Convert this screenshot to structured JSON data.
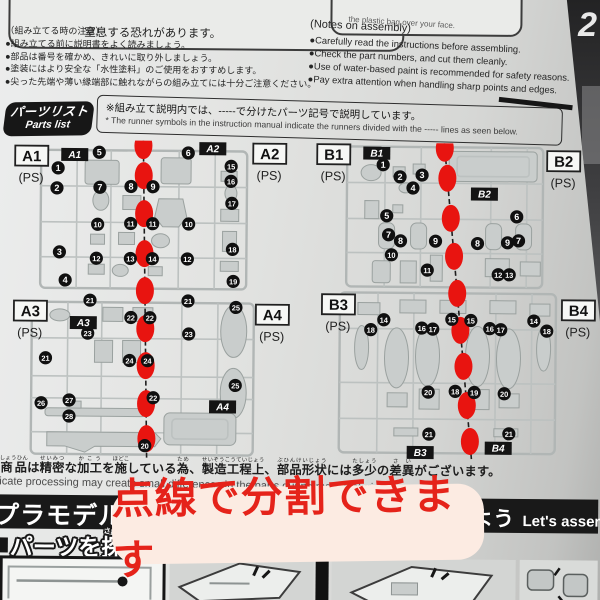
{
  "colors": {
    "marker_red": "#e81410",
    "banner_text": "#e5231a",
    "banner_bg": "#fcebe2"
  },
  "warnings": {
    "left_text": "窒息する恐れがあります。",
    "right_text": "the plastic bag over your face."
  },
  "notes_jp": {
    "title": "（組み立てる時の注意）",
    "items": [
      "●組み立てる前に説明書をよく読みましょう。",
      "●部品は番号を確かめ、きれいに取り外しましょう。",
      "●塗装にはより安全な「水性塗料」のご使用をおすすめします。",
      "●尖った先端や薄い縁端部に触れながらの組み立てには十分ご注意ください。"
    ]
  },
  "notes_en": {
    "title": "(Notes on assembly)",
    "items": [
      "●Carefully read the instructions before assembling.",
      "●Check the part numbers, and cut them cleanly.",
      "●Use of water-based paint is recommended for safety reasons.",
      "●Pay extra attention when handling sharp points and edges."
    ]
  },
  "parts_list": {
    "badge_line1": "パーツリスト",
    "badge_line2": "Parts list",
    "note_jp": "※組み立て説明内では、-----で分けたパーツ記号で説明しています。",
    "note_en": "* The runner symbols in the instruction manual indicate the runners divided with the ----- lines as seen below."
  },
  "runners": {
    "material": "(PS)",
    "blocks": [
      {
        "id": "A",
        "line": {
          "x1": 142,
          "y1": 0,
          "x2": 148,
          "y2": 318
        },
        "dots": [
          5,
          35,
          73,
          113,
          150,
          188,
          225,
          263,
          298
        ],
        "labels": [
          {
            "t": "A1",
            "x": 14,
            "y": 6
          },
          {
            "t": "A2",
            "x": 252,
            "y": 2
          },
          {
            "t": "A3",
            "x": 14,
            "y": 161
          },
          {
            "t": "A4",
            "x": 256,
            "y": 163
          }
        ],
        "badges": [
          {
            "t": "A1",
            "x": 60,
            "y": 8
          },
          {
            "t": "A2",
            "x": 198,
            "y": 1
          },
          {
            "t": "A3",
            "x": 70,
            "y": 176
          },
          {
            "t": "A4",
            "x": 210,
            "y": 259
          }
        ],
        "circles": [
          {
            "n": "1",
            "x": 57,
            "y": 28
          },
          {
            "n": "2",
            "x": 56,
            "y": 48
          },
          {
            "n": "3",
            "x": 59,
            "y": 112
          },
          {
            "n": "4",
            "x": 65,
            "y": 140
          },
          {
            "n": "5",
            "x": 98,
            "y": 12
          },
          {
            "n": "7",
            "x": 99,
            "y": 47
          },
          {
            "n": "8",
            "x": 130,
            "y": 46
          },
          {
            "n": "9",
            "x": 152,
            "y": 46
          },
          {
            "n": "10",
            "x": 97,
            "y": 84
          },
          {
            "n": "11",
            "x": 130,
            "y": 83
          },
          {
            "n": "11",
            "x": 152,
            "y": 83
          },
          {
            "n": "12",
            "x": 96,
            "y": 118
          },
          {
            "n": "13",
            "x": 130,
            "y": 118
          },
          {
            "n": "14",
            "x": 152,
            "y": 118
          },
          {
            "n": "6",
            "x": 187,
            "y": 12
          },
          {
            "n": "10",
            "x": 188,
            "y": 83
          },
          {
            "n": "12",
            "x": 187,
            "y": 118
          },
          {
            "n": "15",
            "x": 230,
            "y": 25
          },
          {
            "n": "16",
            "x": 230,
            "y": 40
          },
          {
            "n": "17",
            "x": 231,
            "y": 62
          },
          {
            "n": "18",
            "x": 232,
            "y": 108
          },
          {
            "n": "19",
            "x": 233,
            "y": 140
          },
          {
            "n": "21",
            "x": 90,
            "y": 160
          },
          {
            "n": "22",
            "x": 131,
            "y": 177
          },
          {
            "n": "22",
            "x": 150,
            "y": 177
          },
          {
            "n": "23",
            "x": 88,
            "y": 193
          },
          {
            "n": "21",
            "x": 46,
            "y": 218
          },
          {
            "n": "24",
            "x": 130,
            "y": 220
          },
          {
            "n": "24",
            "x": 148,
            "y": 220
          },
          {
            "n": "26",
            "x": 42,
            "y": 263
          },
          {
            "n": "27",
            "x": 70,
            "y": 260
          },
          {
            "n": "28",
            "x": 70,
            "y": 276
          },
          {
            "n": "21",
            "x": 188,
            "y": 160
          },
          {
            "n": "23",
            "x": 189,
            "y": 193
          },
          {
            "n": "25",
            "x": 236,
            "y": 166
          },
          {
            "n": "25",
            "x": 236,
            "y": 244
          },
          {
            "n": "22",
            "x": 154,
            "y": 257
          },
          {
            "n": "20",
            "x": 146,
            "y": 305
          }
        ]
      },
      {
        "id": "B",
        "line": {
          "x1": 143,
          "y1": 0,
          "x2": 173,
          "y2": 318
        },
        "dots": [
          5,
          35,
          75,
          113,
          150,
          187,
          223,
          262,
          298
        ],
        "labels": [
          {
            "t": "B1",
            "x": 16,
            "y": 2
          },
          {
            "t": "B2",
            "x": 246,
            "y": 7
          },
          {
            "t": "B3",
            "x": 22,
            "y": 152
          },
          {
            "t": "B4",
            "x": 262,
            "y": 156
          }
        ],
        "badges": [
          {
            "t": "B1",
            "x": 62,
            "y": 4
          },
          {
            "t": "B2",
            "x": 170,
            "y": 44
          },
          {
            "t": "B3",
            "x": 108,
            "y": 303
          },
          {
            "t": "B4",
            "x": 186,
            "y": 298
          }
        ],
        "circles": [
          {
            "n": "1",
            "x": 82,
            "y": 22
          },
          {
            "n": "2",
            "x": 99,
            "y": 34
          },
          {
            "n": "3",
            "x": 121,
            "y": 32
          },
          {
            "n": "4",
            "x": 112,
            "y": 45
          },
          {
            "n": "5",
            "x": 86,
            "y": 73
          },
          {
            "n": "6",
            "x": 216,
            "y": 73
          },
          {
            "n": "7",
            "x": 88,
            "y": 92
          },
          {
            "n": "8",
            "x": 100,
            "y": 98
          },
          {
            "n": "9",
            "x": 135,
            "y": 98
          },
          {
            "n": "8",
            "x": 177,
            "y": 100
          },
          {
            "n": "9",
            "x": 207,
            "y": 99
          },
          {
            "n": "7",
            "x": 218,
            "y": 97
          },
          {
            "n": "10",
            "x": 91,
            "y": 112
          },
          {
            "n": "11",
            "x": 127,
            "y": 127
          },
          {
            "n": "12",
            "x": 198,
            "y": 131
          },
          {
            "n": "13",
            "x": 209,
            "y": 131
          },
          {
            "n": "14",
            "x": 84,
            "y": 177
          },
          {
            "n": "15",
            "x": 152,
            "y": 176
          },
          {
            "n": "15",
            "x": 171,
            "y": 177
          },
          {
            "n": "14",
            "x": 234,
            "y": 177
          },
          {
            "n": "16",
            "x": 122,
            "y": 185
          },
          {
            "n": "17",
            "x": 133,
            "y": 186
          },
          {
            "n": "16",
            "x": 190,
            "y": 185
          },
          {
            "n": "17",
            "x": 201,
            "y": 186
          },
          {
            "n": "18",
            "x": 71,
            "y": 187
          },
          {
            "n": "18",
            "x": 247,
            "y": 187
          },
          {
            "n": "20",
            "x": 129,
            "y": 249
          },
          {
            "n": "18",
            "x": 156,
            "y": 248
          },
          {
            "n": "19",
            "x": 175,
            "y": 249
          },
          {
            "n": "20",
            "x": 205,
            "y": 250
          },
          {
            "n": "21",
            "x": 130,
            "y": 291
          },
          {
            "n": "21",
            "x": 210,
            "y": 290
          }
        ]
      }
    ]
  },
  "bottom_notes": {
    "jp_segments": [
      {
        "t": "商品",
        "r": "しょうひん"
      },
      {
        "t": "は"
      },
      {
        "t": "精密",
        "r": "せいみつ"
      },
      {
        "t": "な"
      },
      {
        "t": "加工",
        "r": "かこう"
      },
      {
        "t": "を"
      },
      {
        "t": "施",
        "r": "ほどこ"
      },
      {
        "t": "している"
      },
      {
        "t": "為",
        "r": "ため"
      },
      {
        "t": "、"
      },
      {
        "t": "製造工程上",
        "r": "せいぞうこうていじょう"
      },
      {
        "t": "、"
      },
      {
        "t": "部品形状",
        "r": "ぶひんけいじょう"
      },
      {
        "t": "には"
      },
      {
        "t": "多少",
        "r": "たしょう"
      },
      {
        "t": "の"
      },
      {
        "t": "差異",
        "r": "さい"
      },
      {
        "t": "がございます。"
      }
    ],
    "en": "icate processing may create small differences in the parts during manufacturing."
  },
  "bottom_band": {
    "left_title": "プラモデルの",
    "right_fragment": "よう",
    "right_en": "Let's assemble",
    "find_parts_segments": [
      {
        "t": "パーツを"
      },
      {
        "t": "探",
        "r": "さが"
      },
      {
        "t": "そう"
      }
    ],
    "find_parts_en": "Find parts"
  },
  "red_banner": {
    "text": "点線で分割できます"
  },
  "edge": {
    "glyph": "2"
  }
}
